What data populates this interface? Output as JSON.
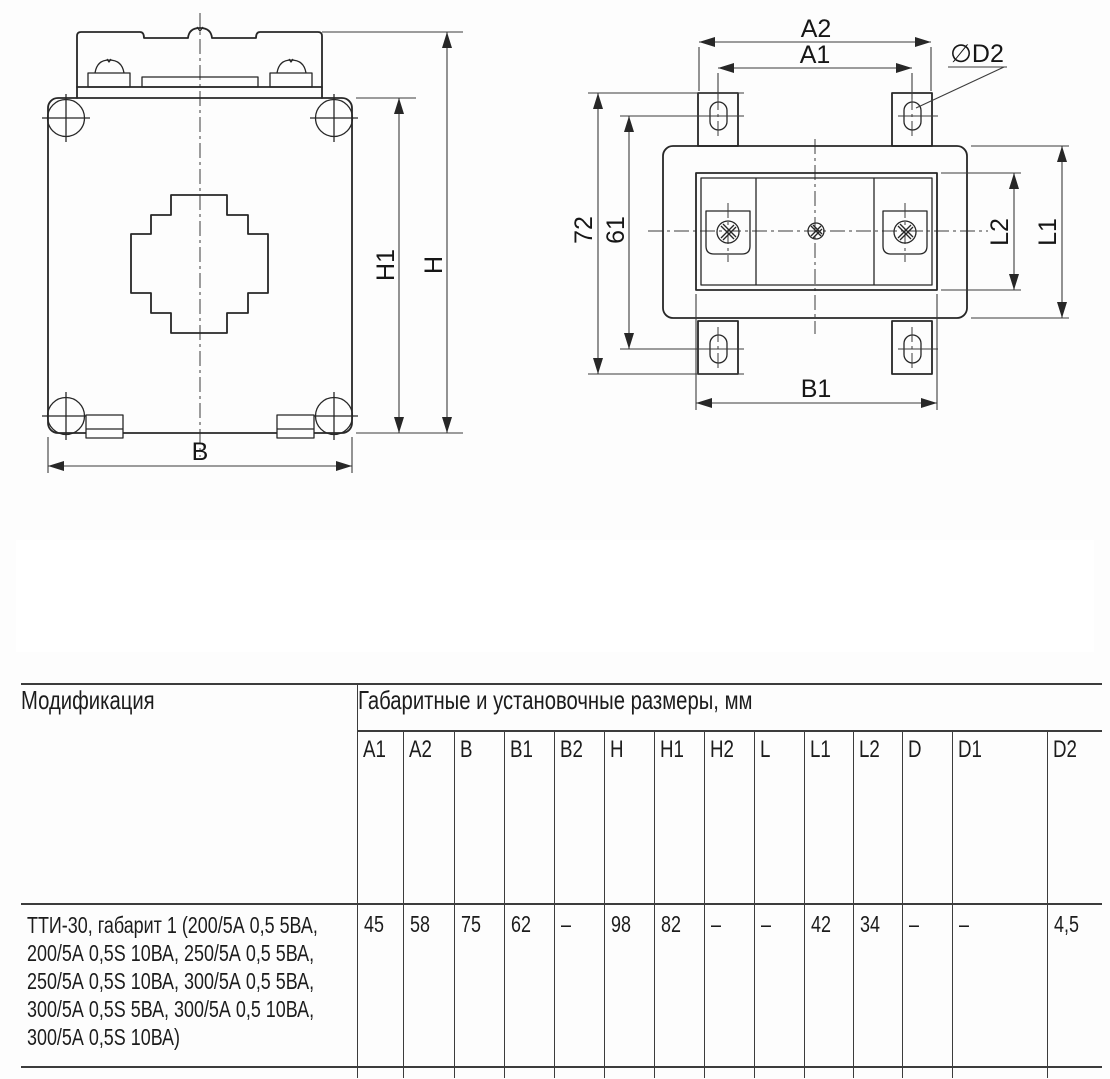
{
  "page": {
    "background": "#fdfdfd",
    "line_color": "#272727",
    "text_color": "#161616"
  },
  "drawing": {
    "front_view": {
      "dims": {
        "B": "B",
        "H": "H",
        "H1": "H1"
      }
    },
    "top_view": {
      "dims": {
        "A2": "A2",
        "A1": "A1",
        "D2": "∅D2",
        "n72": "72",
        "n61": "61",
        "L2": "L2",
        "L1": "L1",
        "B1": "B1"
      }
    }
  },
  "table": {
    "modification_header": "Модификация",
    "dimensions_header": "Габаритные и установочные размеры, мм",
    "columns": [
      "A1",
      "A2",
      "B",
      "B1",
      "B2",
      "H",
      "H1",
      "H2",
      "L",
      "L1",
      "L2",
      "D",
      "D1",
      "D2"
    ],
    "row": {
      "modification_lines": [
        "ТТИ-30, габарит 1 (200/5А 0,5  5ВА,",
        "200/5А 0,5S 10ВА, 250/5А 0,5 5ВА,",
        "250/5А 0,5S 10ВА, 300/5А 0,5 5ВА,",
        "300/5А 0,5S 5ВА, 300/5А 0,5 10ВА,",
        "300/5А 0,5S 10ВА)"
      ],
      "values": [
        "45",
        "58",
        "75",
        "62",
        "–",
        "98",
        "82",
        "–",
        "–",
        "42",
        "34",
        "–",
        "–",
        "4,5"
      ]
    }
  }
}
